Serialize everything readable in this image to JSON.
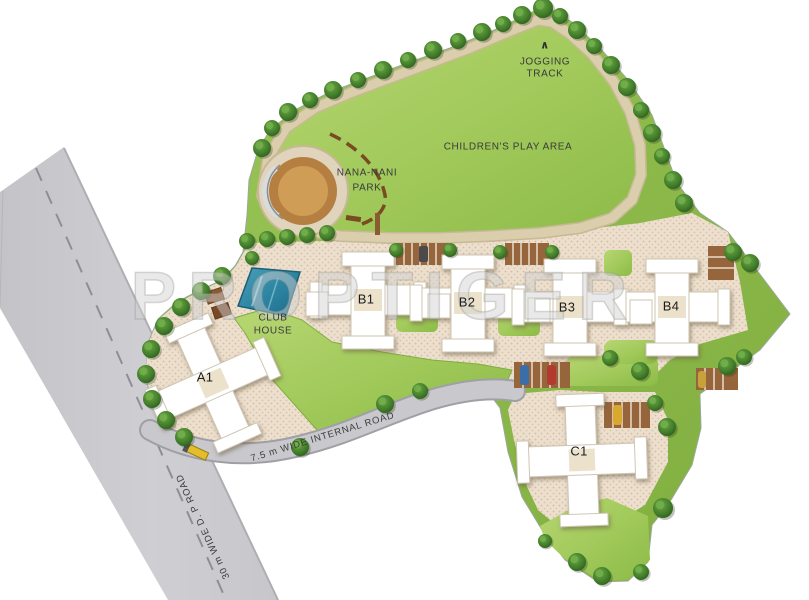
{
  "plan": {
    "watermark": "PROPTIGER",
    "amenities": {
      "jogging_marker": "∧",
      "jogging_line1": "JOGGING",
      "jogging_line2": "TRACK",
      "play_area": "CHILDREN'S PLAY AREA",
      "park_line1": "NANA-NANI",
      "park_line2": "PARK",
      "club_line1": "CLUB",
      "club_line2": "HOUSE"
    },
    "buildings": [
      {
        "label": "A1"
      },
      {
        "label": "B1"
      },
      {
        "label": "B2"
      },
      {
        "label": "B3"
      },
      {
        "label": "B4"
      },
      {
        "label": "C1"
      }
    ],
    "roads": {
      "internal_label": "7.5 m WIDE INTERNAL ROAD",
      "dp_label": "30 m WIDE D. P ROAD"
    },
    "colors": {
      "lawn": "#8fbd4c",
      "field": "#a6cc61",
      "track": "#dbcead",
      "plaza": "#ecdfcd",
      "pool": "#2e86a3",
      "road": "#c9c9cd",
      "parking": "#96653c",
      "tree": "#35661f",
      "gate": "#e3bd2a"
    }
  }
}
